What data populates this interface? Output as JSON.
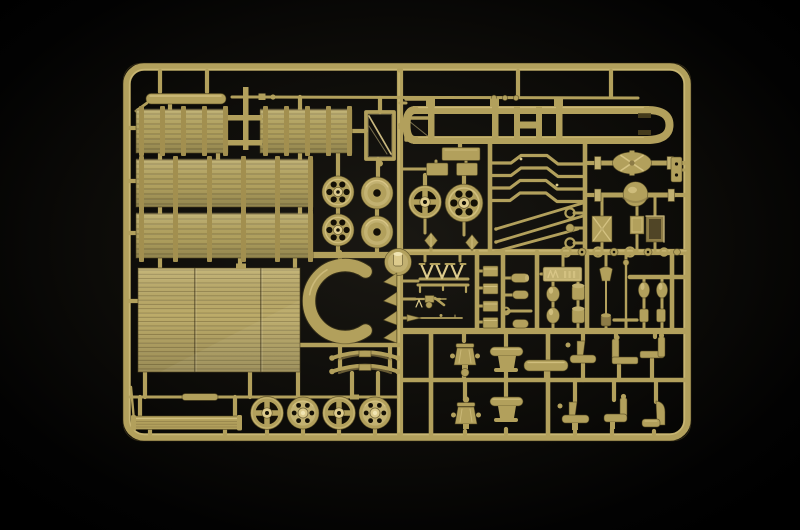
{
  "scene": {
    "type": "photograph",
    "description": "Top-down photograph of a dark-tan injection moulded plastic model kit sprue (military truck parts) lying on a black background",
    "subject": "model-kit-sprue"
  },
  "colors": {
    "background": "#000000",
    "plastic_base": "#b2a05c",
    "plastic_mid": "#c2b171",
    "plastic_light": "#ddcb8c",
    "plastic_lighter": "#f0e4b2",
    "plastic_dark": "#8c7b46",
    "plastic_deep": "#4e431f",
    "hole_dark": "#141006",
    "stake": "#a28f4f",
    "panel_base": "#b0a05e",
    "floor_base": "#bcab69"
  },
  "sprue": {
    "plastic_color_name": "dark tan / khaki",
    "label_plate": {
      "present": true,
      "text_legible": false
    },
    "parts_inventory": {
      "stake_side_panels": 4,
      "cargo_floor_panel": 1,
      "ladder_chassis_frame": 1,
      "road_wheels": 10,
      "axles_with_differential": 2,
      "leaf_springs": 2,
      "suspension_rods": 4,
      "tie_rods": 3,
      "seats_and_saddles": 10,
      "windshield_frame": 1,
      "storage_boxes": 3,
      "spare_wheel_bracket": 1,
      "machine_gun": 1,
      "rifle": 1,
      "small_fittings": "numerous"
    }
  }
}
